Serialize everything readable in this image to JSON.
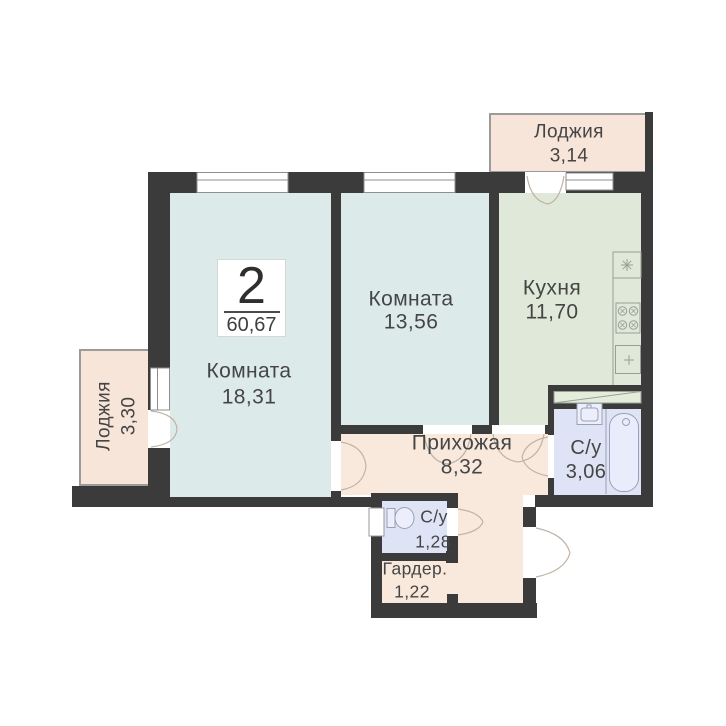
{
  "floorplan": {
    "badge": {
      "rooms_count": "2",
      "total_area": "60,67"
    },
    "rooms": [
      {
        "key": "loggia-top",
        "label": "Лоджия",
        "area": "3,14"
      },
      {
        "key": "kitchen",
        "label": "Кухня",
        "area": "11,70"
      },
      {
        "key": "room-2",
        "label": "Комната",
        "area": "13,56"
      },
      {
        "key": "room-1",
        "label": "Комната",
        "area": "18,31"
      },
      {
        "key": "loggia-left",
        "label": "Лоджия",
        "area": "3,30"
      },
      {
        "key": "hallway",
        "label": "Прихожая",
        "area": "8,32"
      },
      {
        "key": "bathroom",
        "label": "С/у",
        "area": "3,06"
      },
      {
        "key": "wc",
        "label": "С/у",
        "area": "1,28"
      },
      {
        "key": "wardrobe",
        "label": "Гардер.",
        "area": "1,22"
      }
    ],
    "fixtures": [
      "kitchen-sink",
      "stove",
      "kitchen-counter",
      "vent-shaft",
      "bathroom-sink",
      "bathtub",
      "toilet",
      "duct"
    ],
    "colors": {
      "wall": "#3b3b3b",
      "room_fill": "#dcebe9",
      "kitchen_fill": "#e0e9d9",
      "wet_fill": "#dfe3f6",
      "warm_fill": "#f9e9dd",
      "loggia_fill": "#f8e5d9",
      "door_arc": "#c0b3a4",
      "fixture_line": "#96a095"
    }
  }
}
